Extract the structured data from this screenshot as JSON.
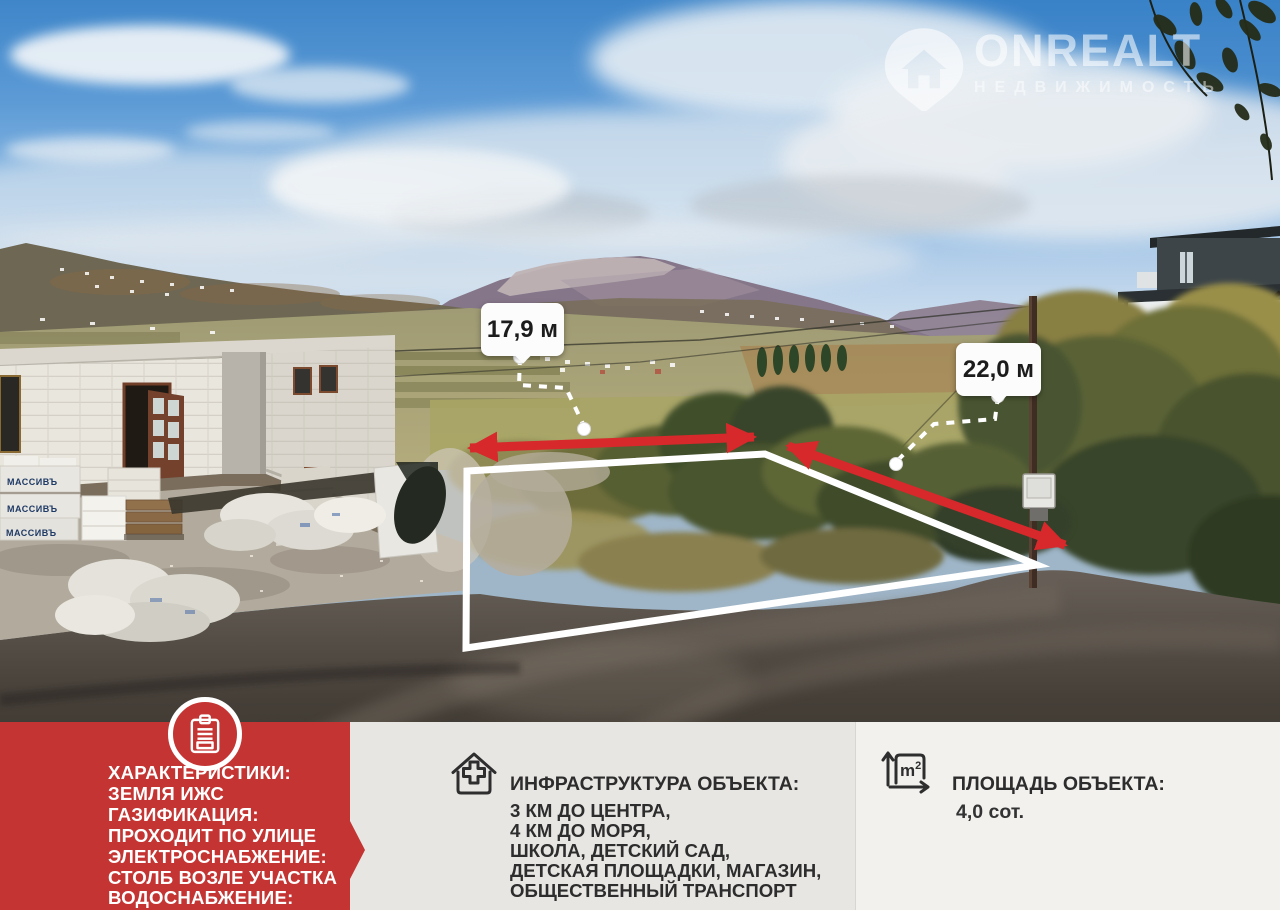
{
  "watermark": {
    "brand": "ONREALT",
    "tagline": "НЕДВИЖИМОСТЬ"
  },
  "photo": {
    "width_label": "17,9 м",
    "depth_label": "22,0 м",
    "blocks_brand": "МАССИВЪ"
  },
  "panels": {
    "characteristics": {
      "lines": [
        "ХАРАКТЕРИСТИКИ:",
        "ЗЕМЛЯ ИЖС",
        "ГАЗИФИКАЦИЯ:",
        "ПРОХОДИТ ПО УЛИЦЕ",
        "ЭЛЕКТРОСНАБЖЕНИЕ:",
        "СТОЛБ ВОЗЛЕ УЧАСТКА",
        "ВОДОСНАБЖЕНИЕ:"
      ]
    },
    "infrastructure": {
      "title": "ИНФРАСТРУКТУРА ОБЪЕКТА:",
      "lines": [
        "3 КМ ДО ЦЕНТРА,",
        "4 КМ ДО МОРЯ,",
        "ШКОЛА, ДЕТСКИЙ САД,",
        "ДЕТСКАЯ ПЛОЩАДКИ, МАГАЗИН,",
        "ОБЩЕСТВЕННЫЙ ТРАНСПОРТ"
      ]
    },
    "area": {
      "title": "ПЛОЩАДЬ ОБЪЕКТА:",
      "value": "4,0 сот."
    }
  },
  "colors": {
    "panel_red": "#c43432",
    "arrow_red": "#d7282b",
    "panel_gray": "#e8e6e3",
    "panel_light": "#f2f1ee",
    "outline_white": "#ffffff"
  }
}
